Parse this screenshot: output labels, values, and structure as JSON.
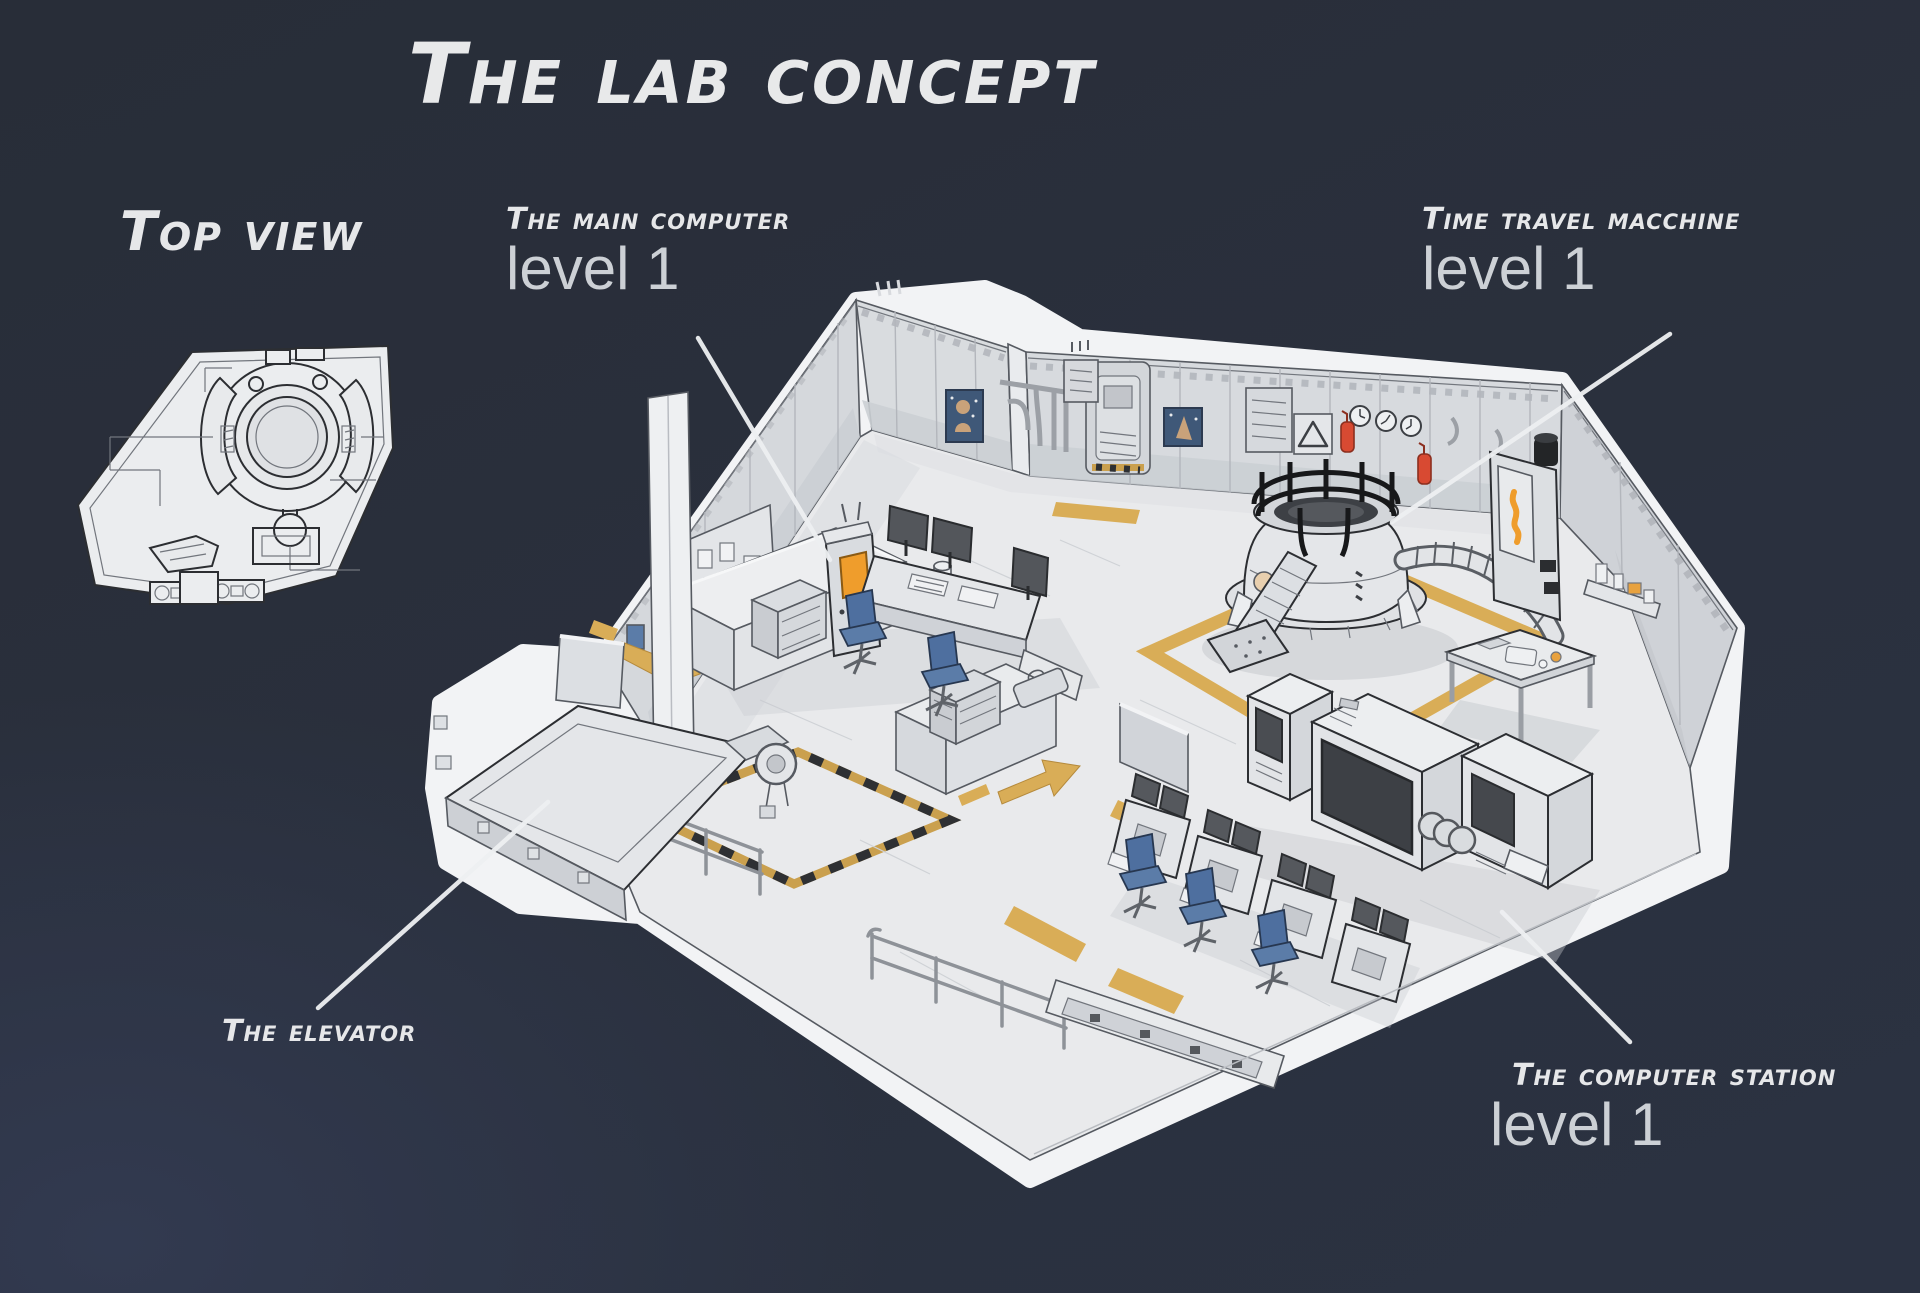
{
  "title": "The lab concept",
  "annotations": {
    "top_view": {
      "label": "Top view"
    },
    "main_computer": {
      "label": "The main computer",
      "level": "level 1"
    },
    "time_machine": {
      "label": "Time travel macchine",
      "level": "level 1"
    },
    "elevator": {
      "label": "The elevator"
    },
    "computer_station": {
      "label": "The computer station",
      "level": "level 1"
    }
  },
  "colors": {
    "background_top": "#282d38",
    "background_bottom_left": "#323a50",
    "label_text": "#e6e7e9",
    "level_text": "#ccd0d5",
    "art_silhouette_white": "#f2f3f5",
    "floor": "#e9eaec",
    "wall": "#d5d8dc",
    "wall_skirting": "#cbcfd4",
    "outline": "#565a61",
    "floor_marking_yellow": "#d9ad57",
    "accent_orange": "#ef9d2c",
    "chair_blue": "#5b7ca8",
    "extinguisher_red": "#d84a32",
    "screen_dark": "#44474c",
    "railing_black": "#17181a",
    "poster_blue": "#3f5878"
  }
}
